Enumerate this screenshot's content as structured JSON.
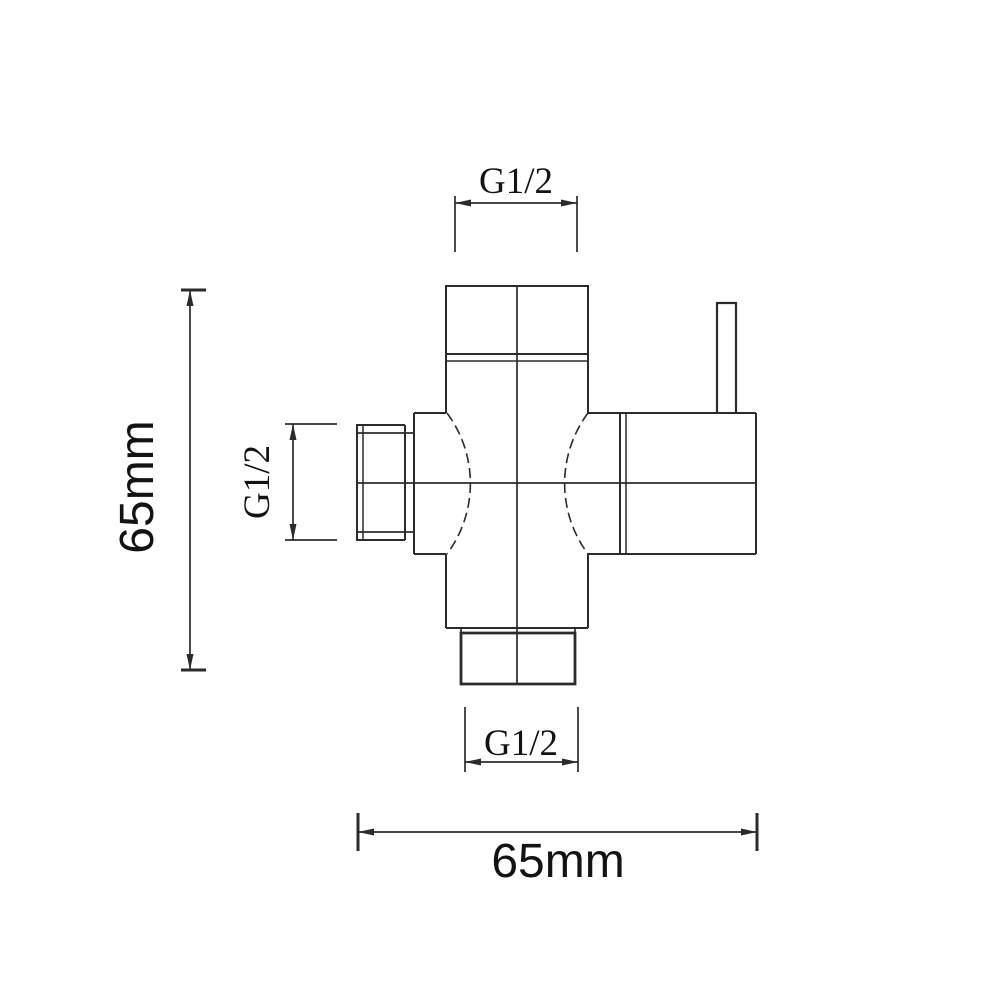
{
  "labels": {
    "top_thread": "G1/2",
    "side_thread": "G1/2",
    "bottom_thread": "G1/2",
    "body_height": "65mm",
    "overall_width": "65mm"
  },
  "colors": {
    "line": "#2b2b2b",
    "text": "#131313",
    "background": "#ffffff"
  }
}
